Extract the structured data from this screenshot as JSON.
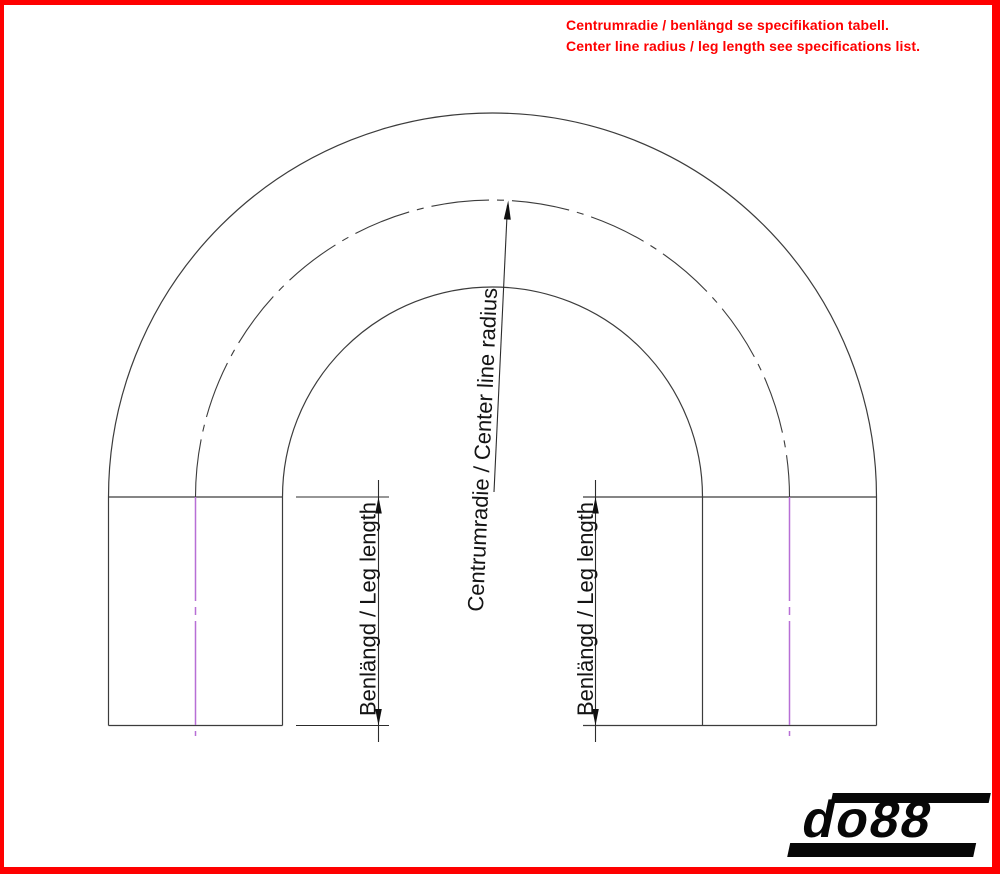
{
  "notice": {
    "line1": "Centrumradie / benlängd se specifikation tabell.",
    "line2": "Center line radius / leg length see specifications list.",
    "color": "#FE0000"
  },
  "diagram": {
    "center_radius_label": "Centrumradie / Center line radius",
    "left_leg_label": "Benlängd / Leg length",
    "right_leg_label": "Benlängd / Leg length",
    "colors": {
      "outline": "#3C3C3C",
      "centerline_magenta": "#B76FD6",
      "arrowheads": "#101010"
    }
  },
  "logo": {
    "text": "do88"
  },
  "frame": {
    "border_color": "#FE0000"
  }
}
